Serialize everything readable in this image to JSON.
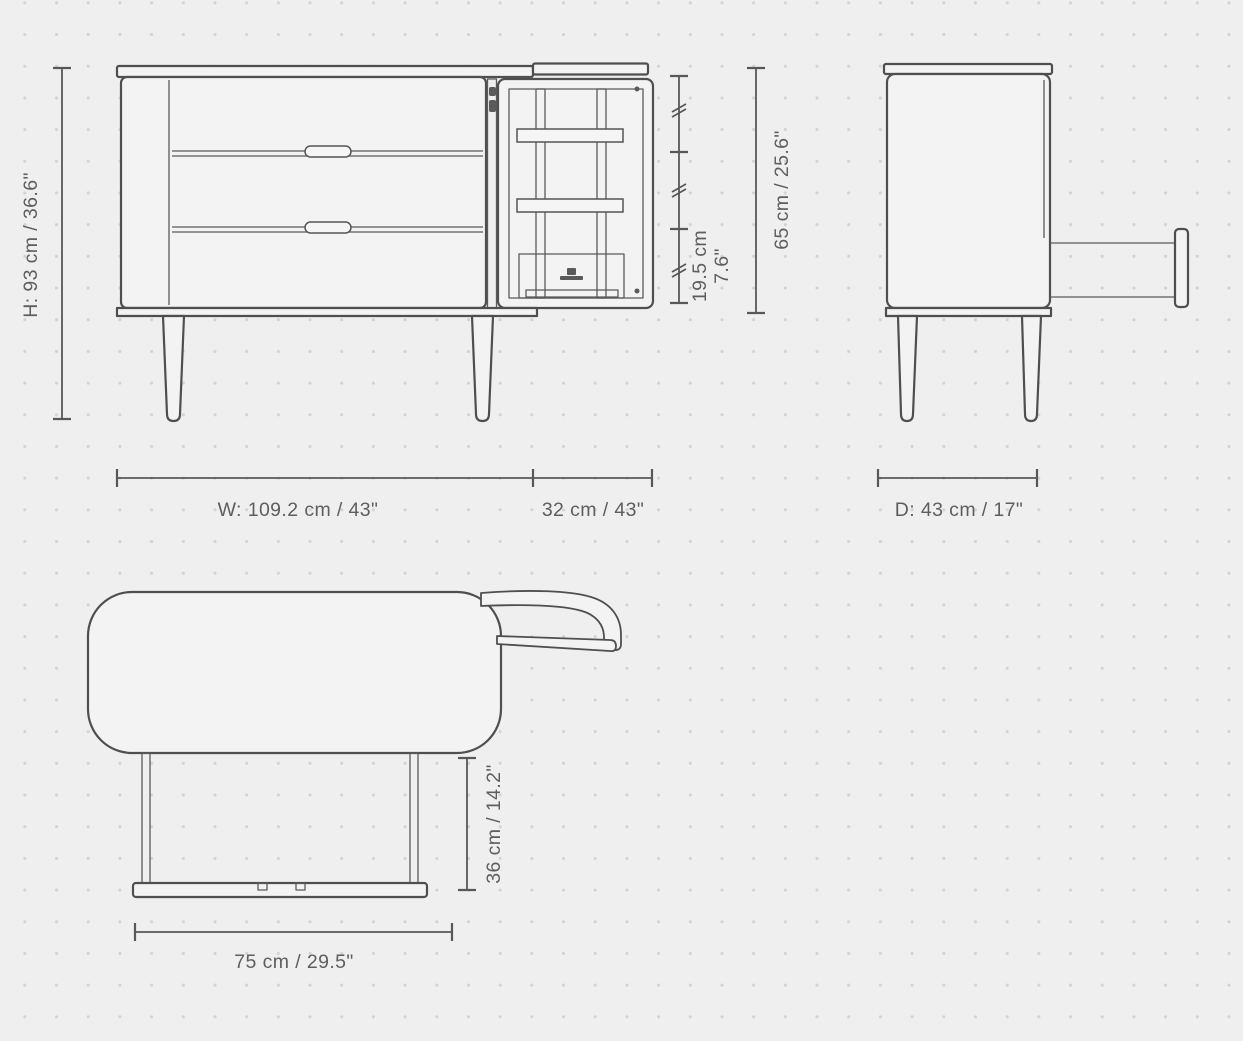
{
  "dimensions": {
    "height": "H: 93 cm / 36.6\"",
    "cabinet_height": "65 cm / 25.6\"",
    "shelf_spacing_cm": "19.5 cm",
    "shelf_spacing_in": "7.6\"",
    "width": "W: 109.2 cm / 43\"",
    "door_width": "32 cm / 43\"",
    "depth": "D: 43 cm / 17\"",
    "drawer_extension": "36 cm / 14.2\"",
    "drawer_width": "75 cm / 29.5\""
  },
  "colors": {
    "background": "#efefef",
    "grid_dot": "#d3d3d3",
    "drawing_line": "#4f4f4f",
    "dimension_line": "#585858",
    "panel_fill": "#f3f3f3"
  }
}
